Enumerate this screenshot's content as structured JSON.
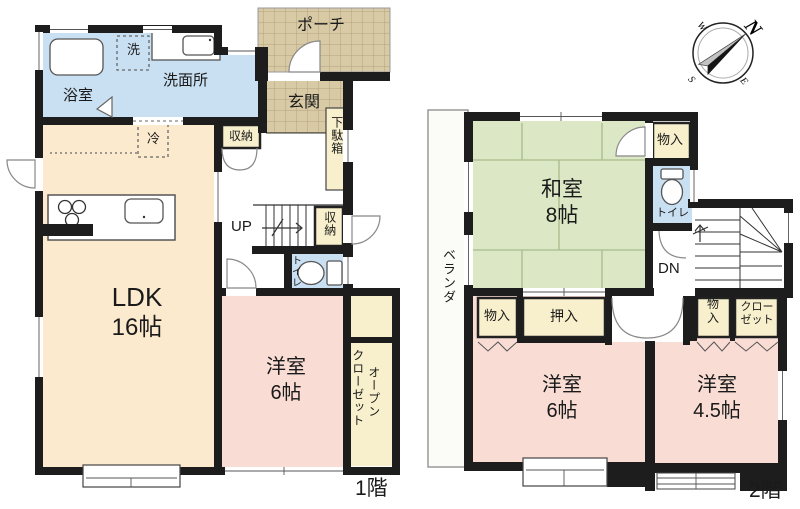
{
  "compass": {
    "n": "N",
    "e": "E",
    "s": "S",
    "w": "W"
  },
  "floor1": {
    "label": "1階",
    "porch": "ポーチ",
    "entrance": "玄関",
    "shoe_cabinet": "下駄箱",
    "bathroom": "浴室",
    "washer": "洗",
    "washroom": "洗面所",
    "hall_storage": "収納",
    "fridge": "冷",
    "ldk": "LDK",
    "ldk_size": "16帖",
    "stairs": "UP",
    "stair_storage": "収納",
    "toilet": "トイレ",
    "bedroom": "洋室",
    "bedroom_size": "6帖",
    "open_closet_word1": "オープン",
    "open_closet_word2": "クローゼット"
  },
  "floor2": {
    "label": "2階",
    "veranda": "ベランダ",
    "tatami_room": "和室",
    "tatami_room_size": "8帖",
    "storage_top": "物入",
    "toilet": "トイレ",
    "stairs": "DN",
    "storage_left": "物入",
    "oshiire": "押入",
    "storage_right": "物入",
    "closet": "クローゼット",
    "bedroom_1": "洋室",
    "bedroom_1_size": "6帖",
    "bedroom_2": "洋室",
    "bedroom_2_size": "4.5帖"
  },
  "colors": {
    "wall": "#1d1d1d",
    "water_blue": "#c9e0f3",
    "ldk_peach": "#fceacf",
    "bedroom_pink": "#f9ddd5",
    "tatami_green": "#dce8c5",
    "storage_cream": "#f8f0cc",
    "tile_tan": "#d9caa6"
  }
}
